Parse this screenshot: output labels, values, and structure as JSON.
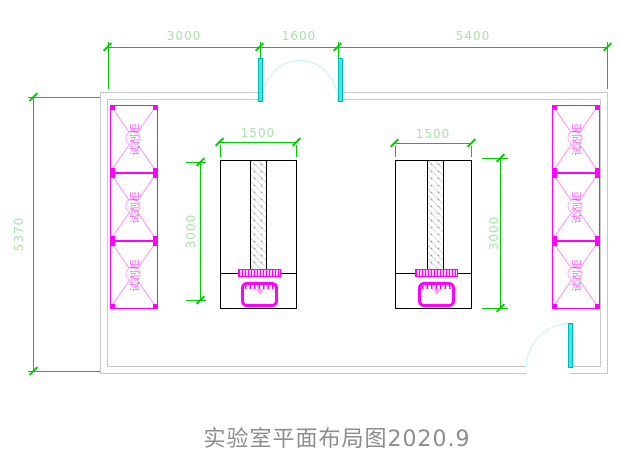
{
  "title": "实验室平面布局图2020.9",
  "colors": {
    "dimension_line": "#00cc00",
    "dimension_text": "#a9e3a9",
    "wall": "#c8c8c8",
    "fixture_magenta": "#ff00ff",
    "door_leaf": "#40e8e8",
    "door_arc": "#c6f2f2",
    "title_text": "#8d8d8d"
  },
  "dimensions": {
    "top_segments": [
      "3000",
      "1600",
      "5400"
    ],
    "left_wall": "5370",
    "bench_left": {
      "width": "1500",
      "depth": "3000"
    },
    "bench_right": {
      "width": "1500",
      "depth": "3000"
    }
  },
  "cabinets": {
    "left": [
      "试剂柜",
      "试剂柜",
      "试剂柜"
    ],
    "right": [
      "试剂柜",
      "试剂柜",
      "试剂柜"
    ]
  }
}
